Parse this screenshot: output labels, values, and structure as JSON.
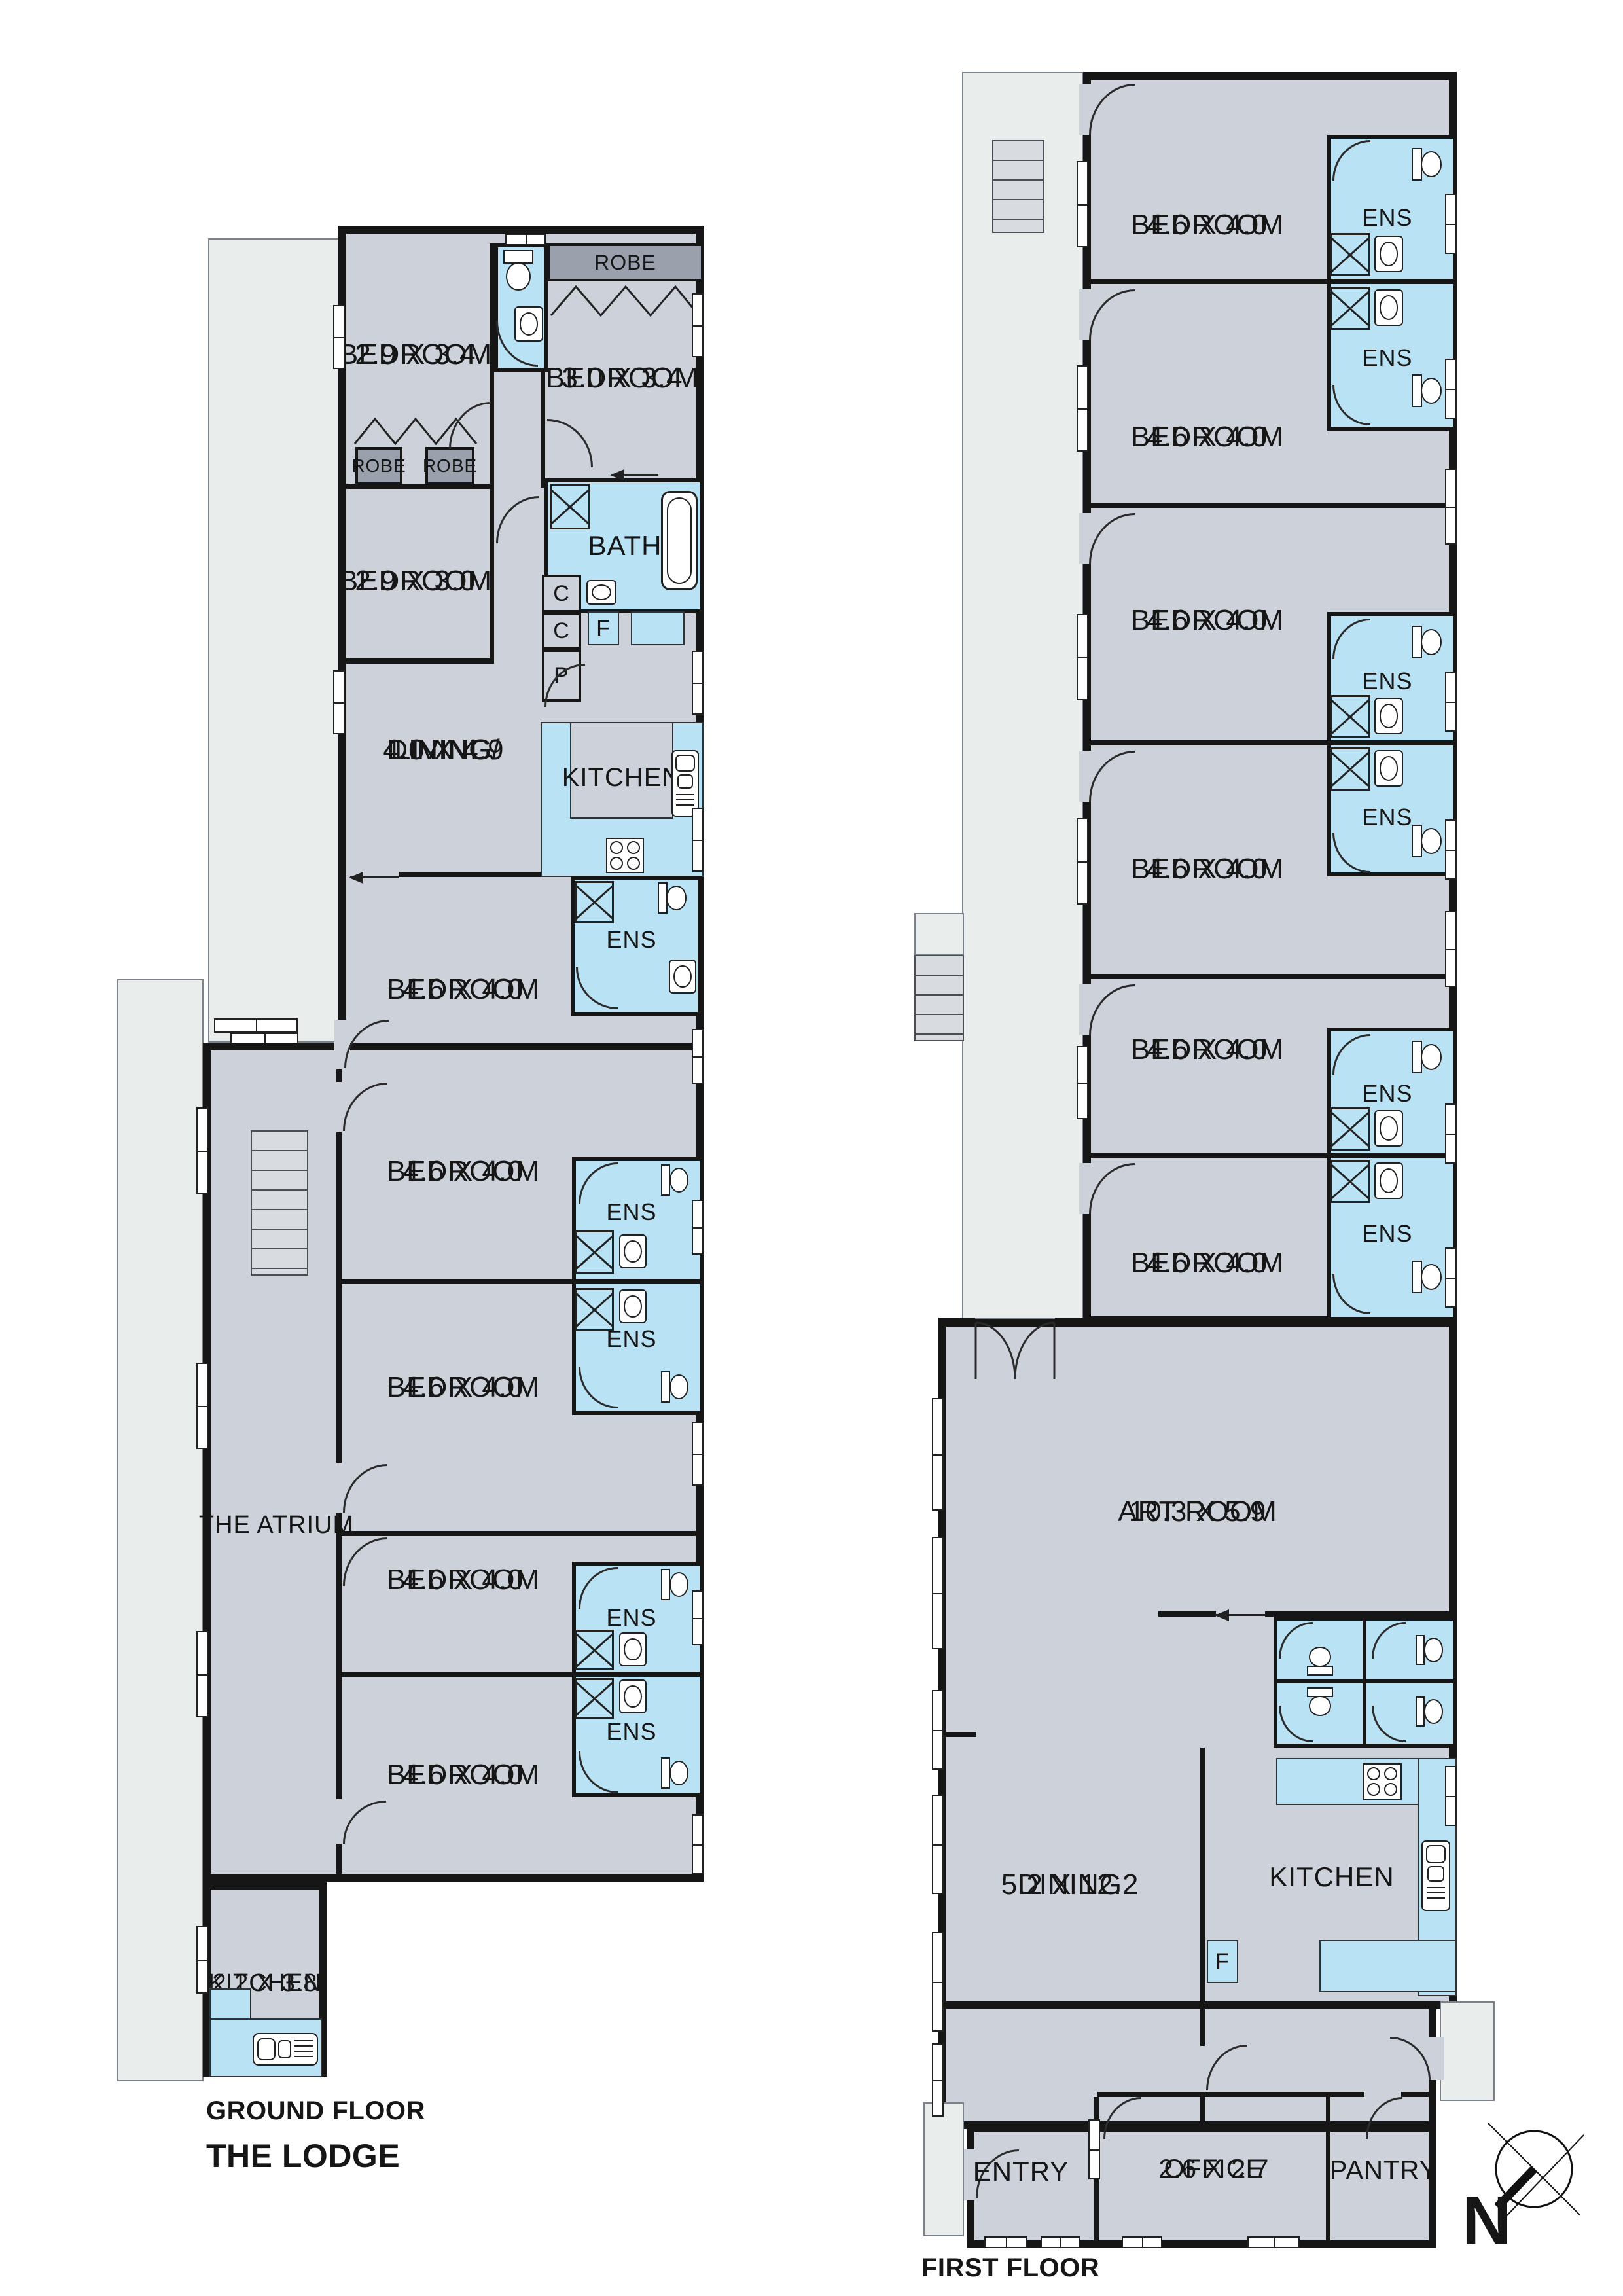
{
  "title": {
    "ground_floor": "GROUND FLOOR",
    "first_floor": "FIRST FLOOR",
    "building": "THE LODGE"
  },
  "labels": {
    "bedroom": "BEDROOM",
    "ens": "ENS",
    "robe": "ROBE",
    "bath": "BATH",
    "kitchen": "KITCHEN",
    "dining_line1": "DINING/",
    "dining_line2": "LIVING",
    "dining": "DINING",
    "art_room": "ART ROOM",
    "atrium": "THE ATRIUM",
    "entry": "ENTRY",
    "office": "OFFICE",
    "pantry": "PANTRY",
    "cupboard": "C",
    "fridge": "F",
    "pantry_small": "P",
    "north": "N"
  },
  "dims": {
    "bed_a": "2.9 X 3.4",
    "bed_b": "3.0 X 3.4",
    "bed_c": "2.9 X 3.0",
    "dining_living": "4.0 X 4.9",
    "bed_std": "4.6 X 4.0",
    "kitchen_gf": "2.2 X 3.8",
    "art_room": "10.3 X 5.9",
    "dining_ff": "5.2 X 12.2",
    "office": "2.6 X 2.7"
  },
  "colors": {
    "wall": "#161616",
    "room_fill": "#ccd1da",
    "wet_area_fill": "#b9e3f4",
    "verandah_fill": "#e9edec",
    "robe_fill": "#9aa1ac"
  }
}
